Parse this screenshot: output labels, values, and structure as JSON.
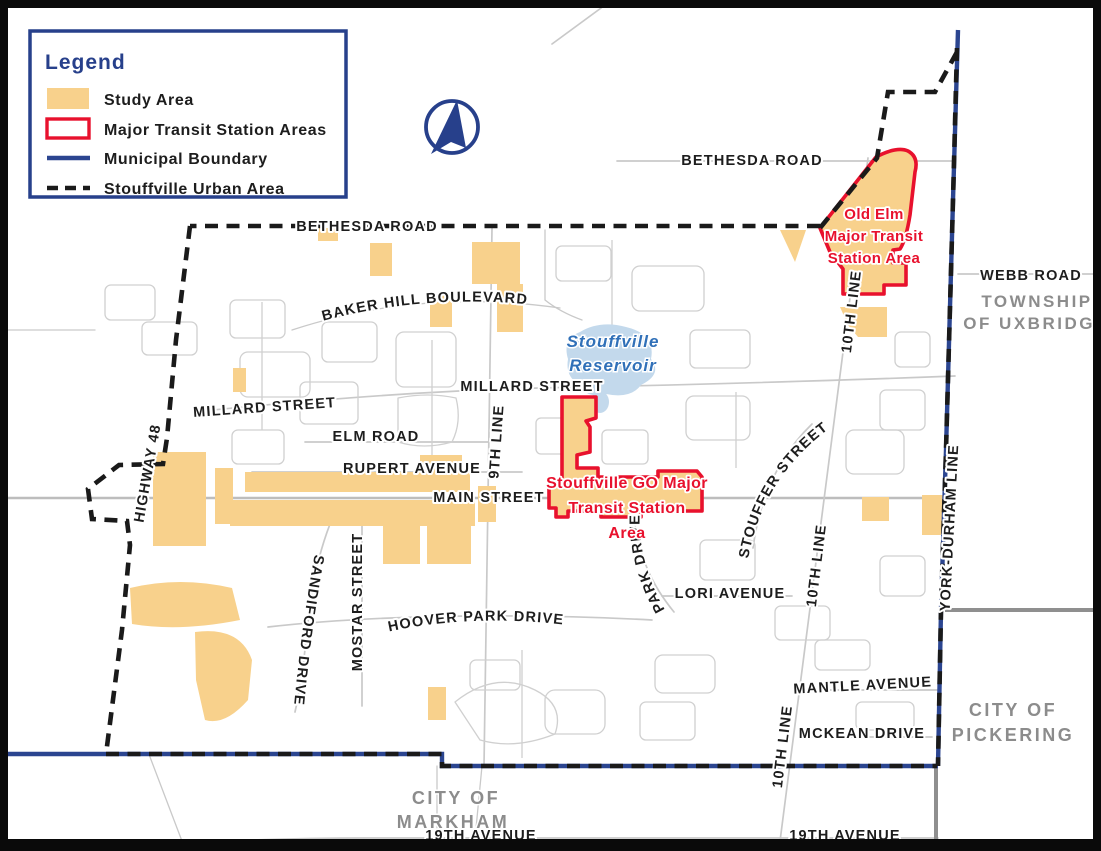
{
  "legend": {
    "title": "Legend",
    "items": [
      {
        "label": "Study Area",
        "swatch": "study-area-fill-swatch"
      },
      {
        "label": "Major Transit Station Areas",
        "swatch": "red-outline-swatch"
      },
      {
        "label": "Municipal Boundary",
        "swatch": "blue-line-swatch"
      },
      {
        "label": "Stouffville Urban Area",
        "swatch": "black-dashed-line-swatch"
      }
    ]
  },
  "labels": {
    "bethesda_top": "BETHESDA ROAD",
    "bethesda_boundary": "BETHESDA ROAD",
    "baker_hill": "BAKER HILL BOULEVARD",
    "millard_center": "MILLARD STREET",
    "millard_west": "MILLARD STREET",
    "elm_road": "ELM ROAD",
    "rupert": "RUPERT AVENUE",
    "main_street": "MAIN STREET",
    "ninth_line": "9TH LINE",
    "highway_48": "HIGHWAY 48",
    "sandiford": "SANDIFORD DRIVE",
    "mostar": "MOSTAR STREET",
    "hoover_park": "HOOVER PARK DRIVE",
    "park_drive": "PARK DRIVE",
    "lori": "LORI AVENUE",
    "stouffer": "STOUFFER STREET",
    "tenth_line_north": "10TH LINE",
    "tenth_line_mid": "10TH LINE",
    "tenth_line_south": "10TH LINE",
    "mantle": "MANTLE AVENUE",
    "mckean": "MCKEAN DRIVE",
    "york_durham": "YORK-DURHAM LINE",
    "nineteenth_west": "19TH AVENUE",
    "nineteenth_east": "19TH AVENUE",
    "webb": "WEBB ROAD"
  },
  "mtsa": {
    "old_elm": [
      "Old Elm",
      "Major Transit",
      "Station Area"
    ],
    "go": [
      "Stouffville GO Major",
      "Transit Station",
      "Area"
    ]
  },
  "water": {
    "line1": "Stouffville",
    "line2": "Reservoir"
  },
  "jurisdictions": {
    "uxbridge_line1": "TOWNSHIP",
    "uxbridge_line2": "OF UXBRIDGE",
    "pickering_line1": "CITY OF",
    "pickering_line2": "PICKERING",
    "markham_line1": "CITY OF",
    "markham_line2": "MARKHAM"
  },
  "icons": {
    "north_arrow": "north-arrow-compass"
  },
  "colors": {
    "study_area": "#F8D18C",
    "mtsa_red": "#E8112D",
    "municipal_blue": "#2B4590",
    "urban_boundary": "#1A1A1A",
    "road_gray": "#C9C9C9",
    "boundary_gray": "#8F8F8F",
    "jurisdiction_gray": "#8C8C8C",
    "water_fill": "#C3D9EC",
    "water_text": "#3070B8",
    "legend_navy": "#27408B",
    "label_black": "#1D1D1D"
  }
}
